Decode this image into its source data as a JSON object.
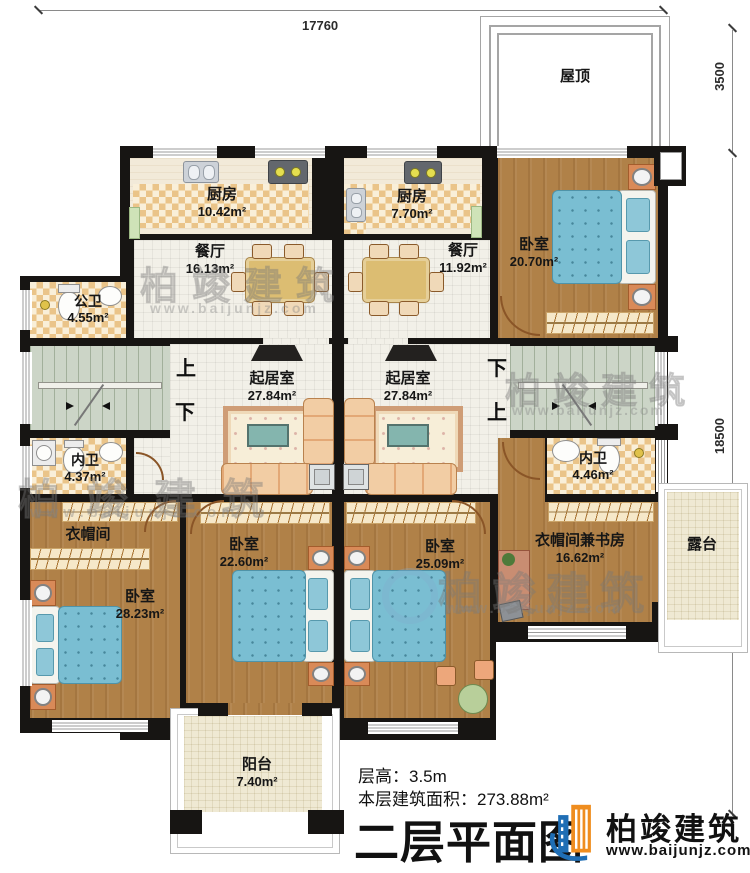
{
  "dimensions": {
    "top": "17760",
    "right_upper": "3500",
    "right_lower": "18500"
  },
  "rooms": {
    "roof": {
      "name": "屋顶"
    },
    "kitchen_left": {
      "name": "厨房",
      "area": "10.42m²"
    },
    "kitchen_right": {
      "name": "厨房",
      "area": "7.70m²"
    },
    "dining_left": {
      "name": "餐厅",
      "area": "16.13m²"
    },
    "dining_right": {
      "name": "餐厅",
      "area": "11.92m²"
    },
    "bedroom_top_right": {
      "name": "卧室",
      "area": "20.70m²"
    },
    "bath_public": {
      "name": "公卫",
      "area": "4.55m²"
    },
    "living_left": {
      "name": "起居室",
      "area": "27.84m²"
    },
    "living_right": {
      "name": "起居室",
      "area": "27.84m²"
    },
    "bath_left": {
      "name": "内卫",
      "area": "4.37m²"
    },
    "bath_right": {
      "name": "内卫",
      "area": "4.46m²"
    },
    "cloakroom": {
      "name": "衣帽间"
    },
    "bedroom_left": {
      "name": "卧室",
      "area": "28.23m²"
    },
    "bedroom_mid_left": {
      "name": "卧室",
      "area": "22.60m²"
    },
    "bedroom_mid_right": {
      "name": "卧室",
      "area": "25.09m²"
    },
    "cloak_study": {
      "name": "衣帽间兼书房",
      "area": "16.62m²"
    },
    "terrace": {
      "name": "露台"
    },
    "balcony": {
      "name": "阳台",
      "area": "7.40m²"
    }
  },
  "stairs": {
    "up": "上",
    "down": "下"
  },
  "footer": {
    "floor_height": "层高：3.5m",
    "floor_area": "本层建筑面积：273.88m²",
    "title": "二层平面图",
    "brand": "柏竣建筑",
    "website": "www.baijunjz.com"
  },
  "watermark": {
    "brand": "柏竣建筑",
    "site": "www.baijunjz.com"
  },
  "colors": {
    "wall": "#171513",
    "wood": "#b08148",
    "tile": "#f2f0e8",
    "checker": "#eac489",
    "stair": "#ccd5c7",
    "bed": "#79bdd1",
    "sofa": "#ecb98b",
    "accent_orange": "#ef8d1f",
    "accent_blue": "#1f6eb5"
  }
}
